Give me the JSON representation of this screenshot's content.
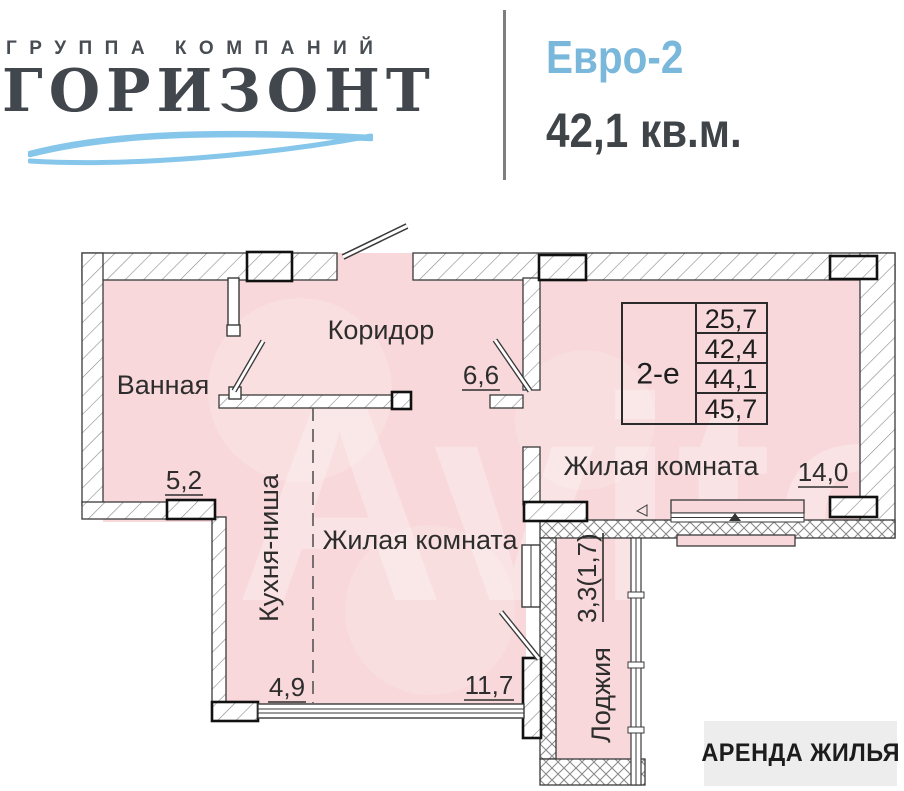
{
  "header": {
    "company_tagline": "ГРУППА КОМПАНИЙ",
    "company_name": "ГОРИЗОНТ",
    "layout_type": "Евро-2",
    "total_area": "42,1 кв.м."
  },
  "plan": {
    "rooms": {
      "bathroom": {
        "name": "Ванная",
        "area": "5,2"
      },
      "corridor": {
        "name": "Коридор",
        "area": "6,6"
      },
      "kitchen_niche": {
        "name": "Кухня-ниша",
        "area": "4,9"
      },
      "living_room_1": {
        "name": "Жилая комната",
        "area": "11,7"
      },
      "living_room_2": {
        "name": "Жилая комната",
        "area": "14,0"
      },
      "loggia": {
        "name": "Лоджия",
        "area": "3,3(1,7)"
      }
    },
    "spec_table": {
      "type_label": "2-е",
      "areas": [
        "25,7",
        "42,4",
        "44,1",
        "45,7"
      ]
    }
  },
  "badge": {
    "label": "АРЕНДА ЖИЛЬЯ"
  },
  "watermark": {
    "text": "Avito"
  },
  "colors": {
    "floor_fill": "#f8d8da",
    "accent_blue": "#79b7db",
    "logo_dark": "#41474d",
    "wave_blue": "#86c6ea",
    "badge_bg": "#ededed"
  }
}
